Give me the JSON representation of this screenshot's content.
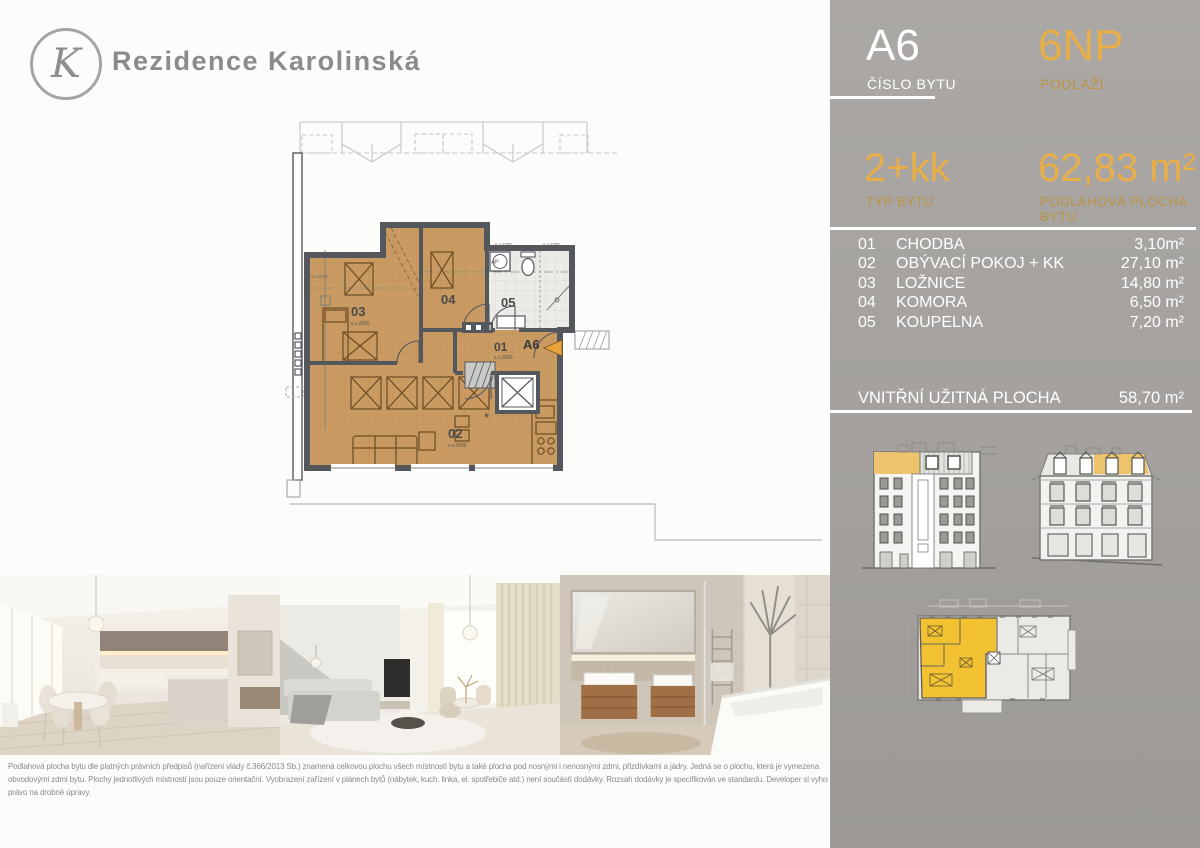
{
  "header": {
    "logo_letter": "K",
    "title": "Rezidence Karolinská"
  },
  "panel": {
    "unit_number": "A6",
    "unit_number_label": "ČÍSLO BYTU",
    "floor": "6NP",
    "floor_label": "PODLAŽÍ",
    "type": "2+kk",
    "type_label": "TYP BYTU",
    "area": "62,83 m²",
    "area_label": "PODLAHOVÁ PLOCHA BYTU",
    "rooms": [
      {
        "num": "01",
        "name": "CHODBA",
        "area": "3,10m²"
      },
      {
        "num": "02",
        "name": "OBÝVACÍ POKOJ + KK",
        "area": "27,10 m²"
      },
      {
        "num": "03",
        "name": "LOŽNICE",
        "area": "14,80 m²"
      },
      {
        "num": "04",
        "name": "KOMORA",
        "area": "6,50 m²"
      },
      {
        "num": "05",
        "name": "KOUPELNA",
        "area": "7,20 m²"
      }
    ],
    "total_label": "VNITŘNÍ UŽITNÁ PLOCHA",
    "total_area": "58,70 m²"
  },
  "plan": {
    "labels": {
      "r01": "01",
      "r02": "02",
      "r03": "03",
      "r04": "04",
      "r05": "05",
      "unit": "A6",
      "ap": "AP",
      "h2600": "s.v.2600",
      "h2300": "s.v.2300"
    }
  },
  "photos": [
    {
      "name": "kitchen and dining interior render"
    },
    {
      "name": "living room interior render"
    },
    {
      "name": "bathroom interior render"
    }
  ],
  "disclaimer": {
    "lines": [
      "Podlahová plocha bytu dle platných právních předpisů (nařízení vlády č.366/2013 Sb.) znamená celkovou plochu všech místností bytu a také plocha pod nosnými i nenosnými zdmi, přizdívkami a jádry. Jedná se o plochu, která je vymezena",
      "obvodovými zdmi bytu. Plochy jednotlivých místností jsou pouze orientační. Vyobrazení zařízení v plánech bytů (nábytek, kuch. linka, el. spotřebiče atd.) není součástí dodávky. Rozsah dodávky je specifikován ve standardu. Developer si vyhrazuje",
      "právo na drobné úpravy."
    ]
  },
  "colors": {
    "accent": "#E8AE47",
    "accent_dim": "#BD9340",
    "panel_gray": "#A6A3A0",
    "highlight_yellow": "#F2C232",
    "wall": "#54585C",
    "wood": "#C99A62"
  }
}
